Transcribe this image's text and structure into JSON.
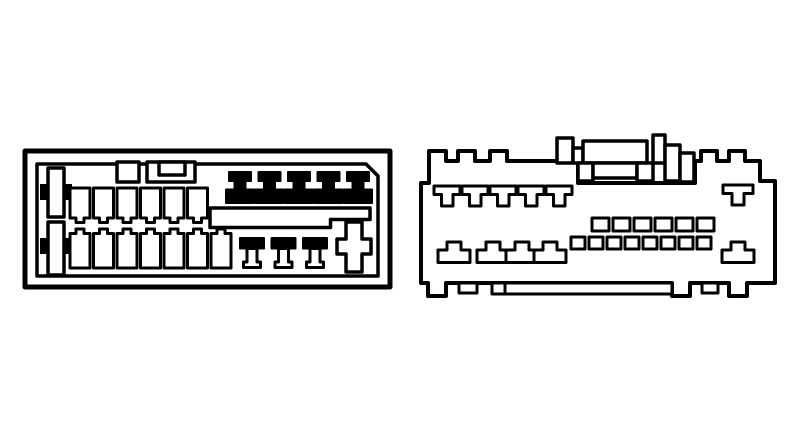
{
  "canvas": {
    "width": 800,
    "height": 425,
    "background": "#ffffff",
    "paper": "#ffffff",
    "ink": "#000000"
  },
  "diagram": {
    "type": "wiring-connector-pinout-drawing",
    "figures_count": 2,
    "connectors": [
      {
        "id": "left-connector",
        "label": "iso-style-radio-connector",
        "shapes": [
          {
            "name": "outer-frame",
            "kind": "rect",
            "x": 25,
            "y": 151,
            "w": 365,
            "h": 136,
            "fill": "white",
            "sw": 5
          },
          {
            "name": "inner-frame",
            "kind": "path",
            "d": "M37,164 H366 L378,176 V276 H37 Z",
            "fill": "none",
            "sw": 3.5
          },
          {
            "name": "keyway-block",
            "kind": "rect",
            "x": 117,
            "y": 162,
            "w": 22,
            "h": 20,
            "fill": "white",
            "sw": 3.5
          },
          {
            "name": "keyway-bracket-outer",
            "kind": "rect",
            "x": 147,
            "y": 162,
            "w": 48,
            "h": 20,
            "fill": "white",
            "sw": 3.5
          },
          {
            "name": "keyway-bracket-inner",
            "kind": "rect",
            "x": 159,
            "y": 162,
            "w": 26,
            "h": 13,
            "fill": "white",
            "sw": 3.5
          },
          {
            "name": "polarizing-key-bar-top",
            "kind": "rect",
            "x": 40,
            "y": 184,
            "w": 32,
            "h": 16,
            "fill": "ink",
            "sw": 0
          },
          {
            "name": "polarizing-key-post-top",
            "kind": "rect",
            "x": 48,
            "y": 168,
            "w": 16,
            "h": 49,
            "fill": "white",
            "sw": 3.5
          },
          {
            "name": "polarizing-key-bar-bottom",
            "kind": "rect",
            "x": 40,
            "y": 238,
            "w": 32,
            "h": 16,
            "fill": "ink",
            "sw": 0
          },
          {
            "name": "polarizing-key-post-bottom",
            "kind": "rect",
            "x": 48,
            "y": 222,
            "w": 16,
            "h": 53,
            "fill": "white",
            "sw": 3.5
          },
          {
            "name": "pin-top-row",
            "kind": "path",
            "d": "M0,0 H20 V30 H14 V34.5 H6 V30 H0 Z",
            "xs": [
              70,
              93.5,
              117,
              140.5,
              164,
              187.5
            ],
            "y0": 188,
            "fill": "white",
            "sw": 3
          },
          {
            "name": "pin-bottom-row",
            "kind": "path",
            "d": "M0,4.5 H6 V0 H14 V4.5 H20 V39 H0 Z",
            "xs": [
              70,
              93.5,
              117,
              140.5,
              164,
              187.5,
              211
            ],
            "y0": 229,
            "fill": "white",
            "sw": 3
          },
          {
            "name": "blade-pin",
            "kind": "path",
            "d": "M3,0 H25 V9 H19.5 V17.5 H28 V31 H0 V17.5 H8.5 V9 H3 Z",
            "xs": [
              226,
              255.5,
              285,
              314.5,
              344
            ],
            "y0": 172,
            "fill": "ink",
            "sw": 2
          },
          {
            "name": "stepped-bar",
            "kind": "path",
            "d": "M210,208 H370 V219.5 H330.5 V227.5 H210 Z",
            "fill": "white",
            "sw": 3.5
          },
          {
            "name": "t-pin-cap",
            "kind": "path",
            "d": "M0,0 H24 V10.5 H0 Z",
            "xs": [
              240,
              271.5,
              303
            ],
            "y0": 238,
            "fill": "ink",
            "sw": 2
          },
          {
            "name": "t-pin-stem",
            "kind": "path",
            "d": "M7,10.5 H17 V24 H20.5 V29.5 H3.5 V24 H7 Z",
            "xs": [
              240,
              271.5,
              303
            ],
            "y0": 238,
            "fill": "white",
            "sw": 3
          },
          {
            "name": "plus-terminal",
            "kind": "path",
            "d": "M346,222 H362 V239 H371 V254 H362 V272 H346 V254 H337 V239 H346 Z",
            "fill": "white",
            "sw": 3.5
          }
        ]
      },
      {
        "id": "right-connector",
        "label": "vehicle-side-connector",
        "shapes": [
          {
            "name": "body-outline",
            "kind": "path",
            "d": "M421,283 V183 H429 V151 H446 V161 H458 V151 H475 V161 H490 V151 H507 V161 H578 V183 H695 V161 H701 V151 H717 V161 H729 V151 H745 V161 H760 V181 H775 V283 H747 V296 H729 V283 H690 V296 H672 V283 H446 V296 H428 V283 Z",
            "fill": "white",
            "sw": 4
          },
          {
            "name": "bottom-rail",
            "kind": "rect",
            "x": 492,
            "y": 283,
            "w": 180,
            "h": 11,
            "fill": "white",
            "sw": 3
          },
          {
            "name": "bottom-rail-divider",
            "kind": "path",
            "d": "M505,283 V294",
            "fill": "none",
            "sw": 3
          },
          {
            "name": "bottom-lug-left",
            "kind": "rect",
            "x": 459,
            "y": 283,
            "w": 18,
            "h": 10,
            "fill": "white",
            "sw": 3
          },
          {
            "name": "bottom-lug-right",
            "kind": "rect",
            "x": 702,
            "y": 283,
            "w": 16,
            "h": 10,
            "fill": "white",
            "sw": 3
          },
          {
            "name": "latch-post-left",
            "kind": "rect",
            "x": 557,
            "y": 138,
            "w": 16,
            "h": 25,
            "fill": "white",
            "sw": 3.5
          },
          {
            "name": "latch-ledge-left",
            "kind": "rect",
            "x": 573,
            "y": 148,
            "w": 10,
            "h": 15,
            "fill": "white",
            "sw": 3.5
          },
          {
            "name": "latch-bridge",
            "kind": "rect",
            "x": 583,
            "y": 141,
            "w": 64,
            "h": 22,
            "fill": "white",
            "sw": 3.5
          },
          {
            "name": "latch-foot-left",
            "kind": "rect",
            "x": 578,
            "y": 163,
            "w": 15,
            "h": 18,
            "fill": "white",
            "sw": 3.5
          },
          {
            "name": "latch-tongue",
            "kind": "rect",
            "x": 593,
            "y": 163,
            "w": 44,
            "h": 15,
            "fill": "white",
            "sw": 3.5
          },
          {
            "name": "latch-foot-right",
            "kind": "rect",
            "x": 637,
            "y": 163,
            "w": 16,
            "h": 18,
            "fill": "white",
            "sw": 3.5
          },
          {
            "name": "latch-post-right",
            "kind": "rect",
            "x": 653,
            "y": 135,
            "w": 12,
            "h": 28,
            "fill": "white",
            "sw": 3.5
          },
          {
            "name": "latch-column-a",
            "kind": "rect",
            "x": 665,
            "y": 145,
            "w": 15,
            "h": 36,
            "fill": "white",
            "sw": 3.5
          },
          {
            "name": "latch-column-b",
            "kind": "rect",
            "x": 680,
            "y": 153,
            "w": 14,
            "h": 29,
            "fill": "white",
            "sw": 3.5
          },
          {
            "name": "t-terminal",
            "kind": "path",
            "d": "M0,0 H26 V8.5 H19 V20 H7.5 V8.5 H0 Z",
            "xs": [
              434,
              462,
              490,
              518,
              546
            ],
            "y0": 186,
            "fill": "white",
            "sw": 3
          },
          {
            "name": "t-terminal-right",
            "kind": "path",
            "d": "M0,0 H30 V8.5 H21 V20 H9 V8.5 H0 Z",
            "xs": [
              723
            ],
            "y0": 185,
            "fill": "white",
            "sw": 3
          },
          {
            "name": "cavity-mid-row",
            "kind": "rect",
            "w": 17,
            "h": 13,
            "xs": [
              592,
              613,
              634,
              655,
              676,
              697
            ],
            "y0": 218,
            "fill": "white",
            "sw": 3
          },
          {
            "name": "cavity-low-row",
            "kind": "rect",
            "w": 14,
            "h": 12,
            "xs": [
              571,
              589,
              607,
              625,
              643,
              661,
              679,
              697
            ],
            "y0": 237,
            "fill": "white",
            "sw": 3
          },
          {
            "name": "castle-terminal",
            "kind": "path",
            "d": "M9,0 H23 V8 H32 V20.5 H0 V8 H9 Z",
            "xs": [
              438,
              477,
              506,
              534
            ],
            "y0": 242,
            "fill": "white",
            "sw": 3
          },
          {
            "name": "castle-terminal-right",
            "kind": "path",
            "d": "M9,0 H23 V8 H32 V20.5 H0 V8 H9 Z",
            "xs": [
              722
            ],
            "y0": 242,
            "fill": "white",
            "sw": 3
          }
        ]
      }
    ]
  }
}
